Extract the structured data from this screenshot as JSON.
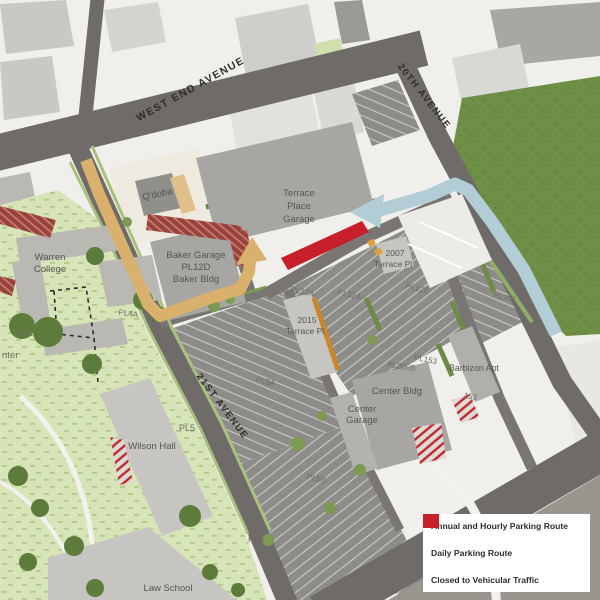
{
  "streets": {
    "west_end_avenue": "WEST END AVENUE",
    "twentieth_avenue": "20TH AVENUE",
    "twenty_first_avenue": "21ST AVENUE"
  },
  "buildings": {
    "qdoba": "Q'doba",
    "terrace_place_garage": [
      "Terrace",
      "Place",
      "Garage"
    ],
    "baker": [
      "Baker Garage",
      "PL12D",
      "Baker Bldg"
    ],
    "warren_college": [
      "Warren",
      "College"
    ],
    "terrace_2007": [
      "2007",
      "Terrace Pl"
    ],
    "terrace_2015": [
      "2015",
      "Terrace Pl"
    ],
    "center_bldg": "Center Bldg",
    "center_garage": [
      "Center",
      "Garage"
    ],
    "wilson_hall": "Wilson Hall",
    "law_school": "Law School",
    "barbizon": "Barbizon Apt"
  },
  "parking_lots": {
    "pl12a_west": "PL12A",
    "pl12a_east": "PL12A",
    "pl12e": "PL12E",
    "pl301": "PL301",
    "pl153": "PL153",
    "lot_153": "153",
    "pl206b": "PL206B",
    "pl4a": "PL4A",
    "pl1": "PL1",
    "edge_partial": "nter",
    "pl5": "PL5",
    "pl5a": "PL5A",
    "pl5b": "PL5B",
    "pl6": "PL6"
  },
  "legend": {
    "items": [
      {
        "key": "annual_hourly",
        "label": "Annual and Hourly Parking Route",
        "color": "#b3cdd6"
      },
      {
        "key": "daily",
        "label": "Daily Parking Route",
        "color": "#d9b16c"
      },
      {
        "key": "closed",
        "label": "Closed to Vehicular Traffic",
        "color": "#c8202a"
      }
    ]
  }
}
